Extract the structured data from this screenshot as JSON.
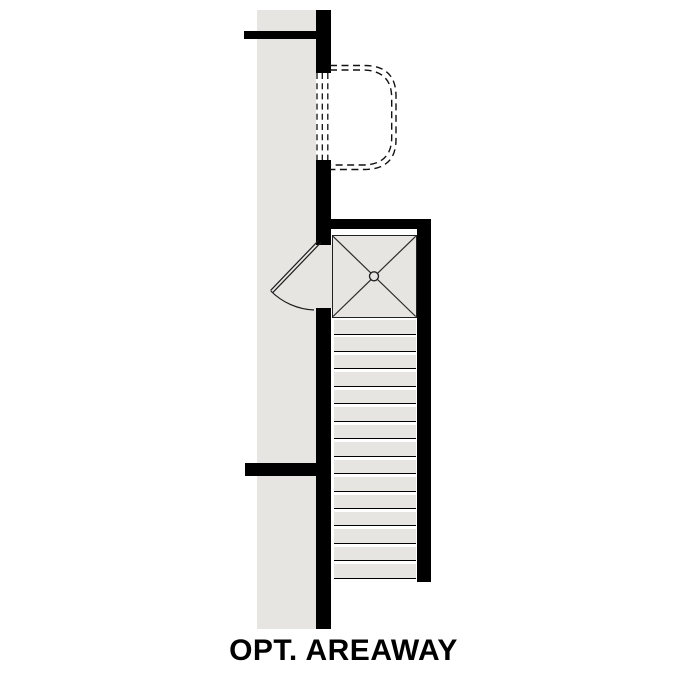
{
  "title": {
    "label": "OPT. AREAWAY"
  },
  "colors": {
    "bg": "#ffffff",
    "wall": "#000000",
    "floor": "#e7e5e2",
    "line": "#1c1c1c"
  },
  "plan": {
    "stairs": {
      "tread_count": 15,
      "direction": "down-vertical"
    },
    "landing": {
      "symbol": "x-braced square with center post circle"
    },
    "door": {
      "type": "quarter-circle swing, hinged at wall opening"
    },
    "areaway": {
      "outline": "dashed double rounded well at basement window"
    }
  }
}
